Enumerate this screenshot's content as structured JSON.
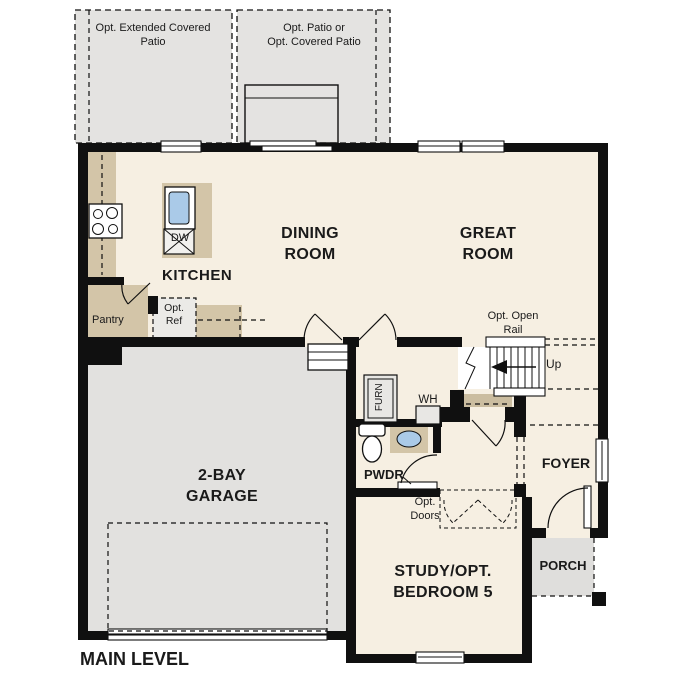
{
  "plan": {
    "title": "MAIN LEVEL",
    "labels": {
      "patio_left": "Opt. Extended Covered\nPatio",
      "patio_right": "Opt. Patio or\nOpt. Covered Patio",
      "kitchen": "KITCHEN",
      "dining": "DINING\nROOM",
      "great": "GREAT\nROOM",
      "dw": "DW",
      "pantry": "Pantry",
      "opt_ref": "Opt.\nRef",
      "opt_open_rail": "Opt. Open\nRail",
      "up": "Up",
      "furn": "FURN",
      "wh": "WH",
      "pwdr": "PWDR",
      "foyer": "FOYER",
      "porch": "PORCH",
      "opt_doors": "Opt.\nDoors",
      "study": "STUDY/OPT.\nBEDROOM 5",
      "garage": "2-BAY\nGARAGE",
      "main_level": "MAIN LEVEL"
    },
    "colors": {
      "floor": "#f6efe2",
      "garage": "#e2e1df",
      "patio": "#e4e3e1",
      "porch": "#dfdedc",
      "counter": "#d3c5a8",
      "closet": "#cbbda0",
      "sink": "#aacae8",
      "wall": "#101010",
      "text": "#1a1a1a"
    }
  }
}
